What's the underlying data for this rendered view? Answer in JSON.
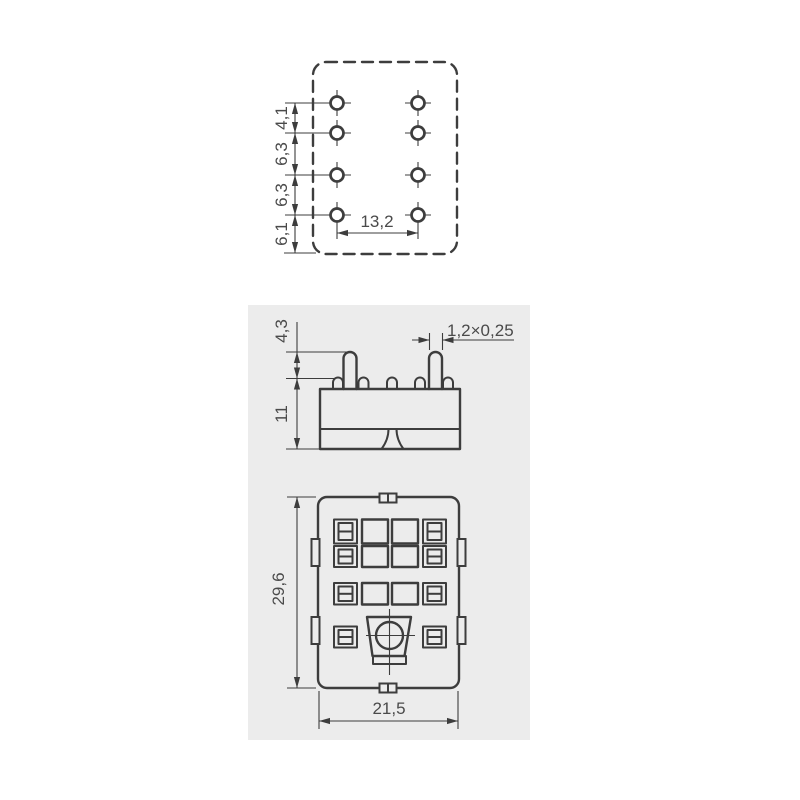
{
  "colors": {
    "background": "#ffffff",
    "panel": "#ececec",
    "line": "#3d3d3d",
    "text": "#4a4a4a"
  },
  "dimensions": {
    "top_view": {
      "pitch1": "4,1",
      "pitch2": "6,3",
      "pitch3": "6,3",
      "pitch4": "6,1",
      "column_span": "13,2"
    },
    "side_view": {
      "pin_height": "4,3",
      "body_height": "11",
      "pin_cross_section": "1,2×0,25"
    },
    "front_view": {
      "height": "29,6",
      "width": "21,5"
    }
  }
}
